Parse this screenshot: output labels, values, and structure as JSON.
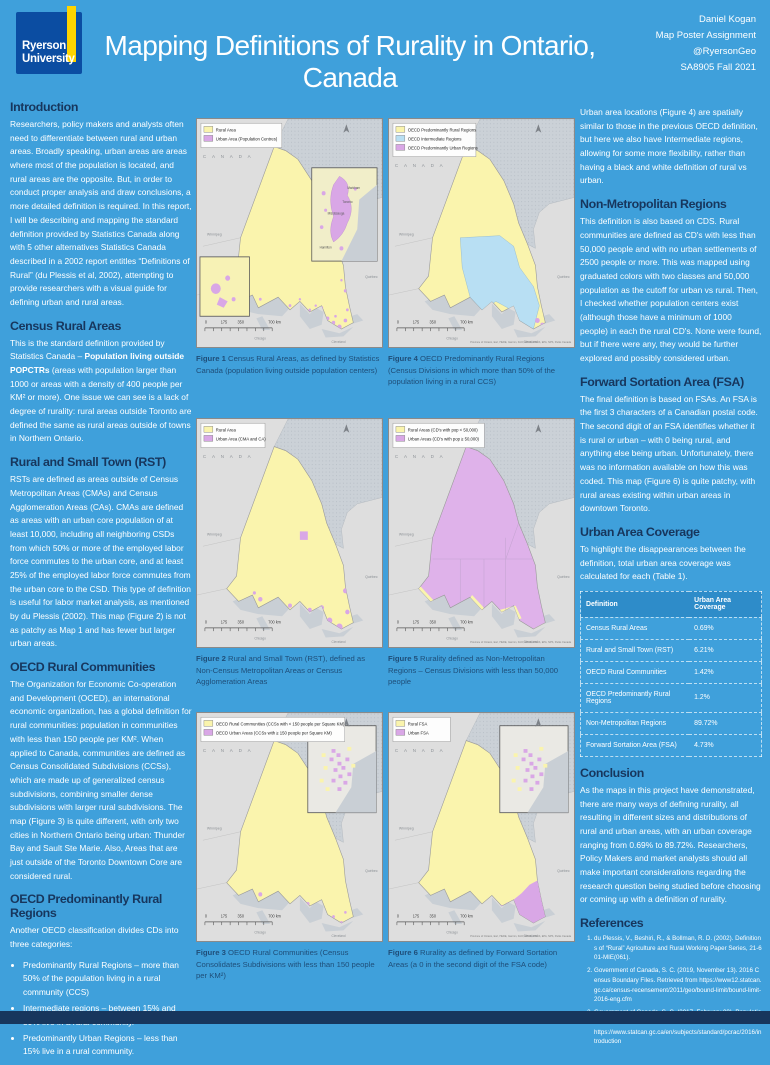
{
  "colors": {
    "poster_bg": "#3FA0DB",
    "heading": "#17365D",
    "caption": "#1F4E79",
    "body_text": "#FFFFFF",
    "logo_bg": "#0B4DA2",
    "logo_stripe": "#FFD400",
    "footer": "#17365D",
    "table_header_bg": "#2E8CC9",
    "map_land": "#DEDEDE",
    "map_water": "#C9CFD5",
    "rural_yellow": "#FAF4AD",
    "urban_purple": "#D9A7E6",
    "intermediate_blue": "#B8DFF3"
  },
  "header": {
    "logo_line1": "Ryerson",
    "logo_line2": "University",
    "title": "Mapping Definitions of Rurality in Ontario, Canada",
    "credits": [
      "Daniel Kogan",
      "Map Poster Assignment",
      "@RyersonGeo",
      "SA8905 Fall 2021"
    ]
  },
  "left_column": {
    "sections": [
      {
        "heading": "Introduction",
        "paras": [
          "Researchers, policy makers and analysts often need to differentiate between rural and urban areas. Broadly speaking, urban areas are areas where most of the population is located, and rural areas are the opposite. But, in order to conduct proper analysis and draw conclusions, a more detailed definition is required. In this report, I will be describing and mapping the standard definition provided by Statistics Canada along with 5 other alternatives Statistics Canada described in a 2002 report entitles “Definitions of Rural”  (du Plessis et al, 2002), attempting to provide researchers with a visual guide for defining urban and rural areas."
        ]
      },
      {
        "heading": "Census Rural Areas",
        "paras": [
          "This is the standard definition provided by Statistics Canada – **Population living outside POPCTRs** (areas with population larger than 1000 or areas with a density of 400 people per KM² or more).  One issue we can see is a lack of degree of rurality: rural areas outside Toronto are defined the same as rural areas outside of towns in Northern Ontario."
        ]
      },
      {
        "heading": "Rural and Small Town (RST)",
        "paras": [
          "RSTs are defined as areas outside of Census Metropolitan Areas (CMAs) and Census Agglomeration Areas (CAs). CMAs are defined as areas with an urban core population of at least 10,000, including all neighboring CSDs from which 50% or more of the employed labor force commutes to the urban core, and at least 25% of the employed labor force commutes from the urban core to the CSD. This type of definition is useful for labor market analysis, as mentioned by du Plessis (2002). This map (Figure 2) is not as patchy as Map 1 and has fewer but larger urban areas."
        ]
      },
      {
        "heading": "OECD Rural Communities",
        "paras": [
          "The Organization for Economic Co-operation and Development (OCED), an international economic organization, has a global definition for rural communities: population in communities with less than 150 people per KM². When applied to Canada, communities are defined as Census Consolidated Subdivisions (CCSs), which are made up of generalized census subdivisions, combining smaller dense subdivisions with larger rural subdivisions. The map (Figure 3) is quite different, with only two cities in Northern Ontario being urban: Thunder Bay and Sault Ste Marie. Also, Areas that are just outside of the Toronto Downtown Core are considered rural."
        ]
      },
      {
        "heading": "OECD Predominantly Rural Regions",
        "paras": [
          "Another OECD classification divides CDs into three categories:"
        ],
        "bullets": [
          "Predominantly Rural Regions – more than 50% of the population living in a rural community (CCS)",
          "Intermediate regions – between 15% and 50% live in a rural community.",
          "Predominantly Urban Regions – less than 15% live in a rural community."
        ]
      }
    ]
  },
  "right_column": {
    "sections": [
      {
        "paras": [
          "Urban area locations (Figure 4)  are spatially similar to those in the previous OECD definition, but here we also have Intermediate regions, allowing for some more flexibility, rather than having a black and white definition of rural vs urban."
        ]
      },
      {
        "heading": "Non-Metropolitan Regions",
        "paras": [
          "This definition is also based on CDS.  Rural communities are defined as CD's with less than 50,000 people and with no urban settlements of 2500 people or more.  This was mapped using graduated colors with two classes and 50,000 population as the cutoff for urban vs rural. Then, I checked whether population centers exist (although those have a minimum of 1000 people) in each the rural CD's.  None were found, but if there were any, they would be further explored and possibly considered urban."
        ]
      },
      {
        "heading": "Forward Sortation Area (FSA)",
        "paras": [
          "The final definition is based on FSAs. An FSA is the first 3 characters of a Canadian postal code. The second digit of an FSA identifies whether it is rural or urban – with 0 being rural, and anything else being urban. Unfortunately, there was no information available on how this was coded. This map (Figure 6) is quite patchy, with rural areas existing within urban areas in downtown Toronto."
        ]
      },
      {
        "heading": "Urban Area Coverage",
        "paras": [
          "To highlight the disappearances between the definition, total urban area coverage was calculated for each (Table 1)."
        ],
        "table": {
          "headers": [
            "Definition",
            "Urban Area Coverage"
          ],
          "rows": [
            [
              "Census Rural Areas",
              "0.69%"
            ],
            [
              "Rural and Small Town (RST)",
              "6.21%"
            ],
            [
              "OECD Rural Communities",
              "1.42%"
            ],
            [
              "OECD Predominantly Rural Regions",
              "1.2%"
            ],
            [
              "Non-Metropolitan Regions",
              "89.72%"
            ],
            [
              "Forward Sortation Area (FSA)",
              "4.73%"
            ]
          ]
        }
      },
      {
        "heading": "Conclusion",
        "paras": [
          "As the maps in this project have demonstrated, there are many ways of defining rurality, all resulting in different sizes and distributions of rural and urban areas, with an urban coverage ranging from 0.69% to 89.72%. Researchers, Policy Makers and market analysts should all make important considerations regarding the research question being studied before choosing or coming up with a definition of rurality."
        ]
      },
      {
        "heading": "References",
        "refs": [
          "du Plessis, V., Beshiri, R., & Bollman, R. D. (2002). Definitions of “Rural” Agriculture and Rural Working Paper Series,  21-601-MIE(061).",
          "Government of Canada, S. C. (2019, November 13). 2016 Census Boundary Files. Retrieved from https://www12.statcan.gc.ca/census-recensement/2011/geo/bound-limit/bound-limit-2016-eng.cfm",
          "Government of Canada, S. C. (2017, February 08). Population Centre and Rural Area Classification 2016. Retrieved from https://www.statcan.gc.ca/en/subjects/standard/pcrac/2016/introduction"
        ]
      }
    ]
  },
  "map_common": {
    "canada_label": "C A N A D A",
    "scale_labels": [
      "0",
      "175",
      "350",
      "700 km"
    ],
    "city_labels": {
      "winnipeg": "Winnipeg",
      "quebec": "Québec",
      "chicago": "Chicago",
      "cleveland": "Cleveland"
    },
    "inset_labels": [
      "Markham",
      "Toronto",
      "Mississauga",
      "Hamilton"
    ],
    "attribution": "Province of Ontario, Esri, HERE, Garmin, FAO, NOAA, USGS, EPA, NPS, Parks Canada"
  },
  "maps": [
    {
      "id": "figure-1",
      "variant": "census",
      "legend": [
        {
          "label": "Rural Area",
          "color": "#FAF4AD"
        },
        {
          "label": "Urban Area (Population Centres)",
          "color": "#D9A7E6"
        }
      ],
      "fills": {
        "ontario": "#FAF4AD",
        "urban": "#D9A7E6"
      },
      "caption_label": "Figure 1",
      "caption_text": "Census Rural Areas, as defined by Statistics Canada (population living outside population centers)"
    },
    {
      "id": "figure-4",
      "variant": "oecdReg",
      "legend": [
        {
          "label": "OECD Predominantly Rural Regions",
          "color": "#FAF4AD"
        },
        {
          "label": "OECD Intermediate Regions",
          "color": "#B8DFF3"
        },
        {
          "label": "OECD Predominantly Urban Regions",
          "color": "#D9A7E6"
        }
      ],
      "fills": {
        "ontario": "#FAF4AD",
        "urban": "#D9A7E6",
        "intermediate": "#B8DFF3"
      },
      "caption_label": "Figure 4",
      "caption_text": "OECD Predominantly Rural Regions (Census Divisions in which more than 50% of the population living in a rural CCS)"
    },
    {
      "id": "figure-2",
      "variant": "rst",
      "legend": [
        {
          "label": "Rural Area",
          "color": "#FAF4AD"
        },
        {
          "label": "Urban Area (CMA and CA)",
          "color": "#D9A7E6"
        }
      ],
      "fills": {
        "ontario": "#FAF4AD",
        "urban": "#D9A7E6"
      },
      "caption_label": "Figure 2",
      "caption_text": "Rural and Small Town (RST), defined as Non-Census Metropolitan Areas or Census Agglomeration Areas"
    },
    {
      "id": "figure-5",
      "variant": "nonmetro",
      "legend": [
        {
          "label": "Rural Areas (CD's with pop < 50,000)",
          "color": "#FAF4AD"
        },
        {
          "label": "Urban Areas (CD's with pop ≥ 50,000)",
          "color": "#D9A7E6"
        }
      ],
      "fills": {
        "ontario": "#DFB2EA",
        "urban": "#D9A7E6",
        "patch": "#FAF4AD"
      },
      "caption_label": "Figure 5",
      "caption_text": "Rurality defined as Non-Metropolitan Regions – Census Divisions with less than 50,000 people"
    },
    {
      "id": "figure-3",
      "variant": "oecdComm",
      "legend": [
        {
          "label": "OECD Rural Communities (CCSs with < 150 people per Square KM)",
          "color": "#FAF4AD"
        },
        {
          "label": "OECD Urban Areas (CCSs with ≥ 150 people per Square KM)",
          "color": "#D9A7E6"
        }
      ],
      "fills": {
        "ontario": "#FAF4AD",
        "urban": "#D9A7E6"
      },
      "caption_label": "Figure 3",
      "caption_text": "OECD Rural Communities (Census Consolidates Subdivisions with less than 150 people per KM²)"
    },
    {
      "id": "figure-6",
      "variant": "fsa",
      "legend": [
        {
          "label": "Rural FSA",
          "color": "#FAF4AD"
        },
        {
          "label": "Urban FSA",
          "color": "#D9A7E6"
        }
      ],
      "fills": {
        "ontario": "#FAF4AD",
        "urban": "#D9A7E6"
      },
      "caption_label": "Figure 6",
      "caption_text": "Rurality as defined by Forward Sortation Areas (a 0 in the second digit of the FSA code)"
    }
  ]
}
